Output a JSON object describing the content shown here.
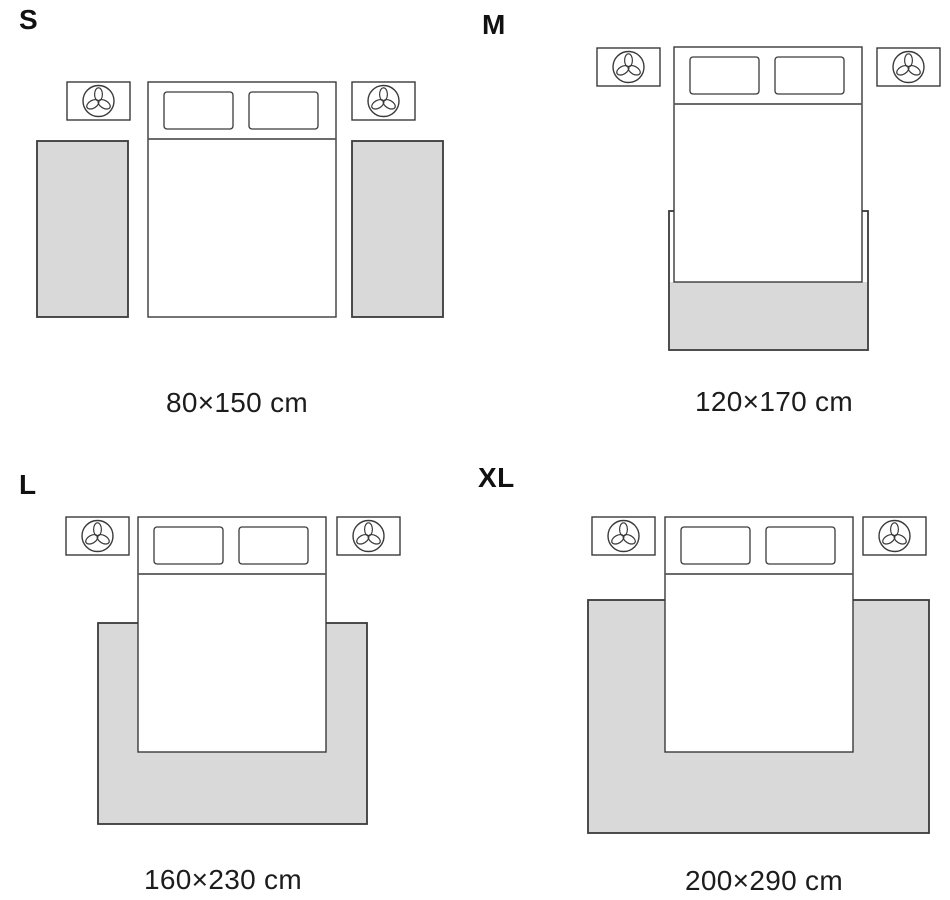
{
  "colors": {
    "background": "#ffffff",
    "rug_fill": "#d9d9d9",
    "outline": "#3a3a3a",
    "label_text": "#111111",
    "caption_text": "#1c1c1c"
  },
  "icons": {
    "nightstand_decoration": "plant-icon"
  },
  "quadrants": [
    {
      "id": "s",
      "label": "S",
      "caption": "80×150 cm",
      "size_cm": {
        "width": 80,
        "length": 150
      },
      "rug_layout": "two side runners beside bed"
    },
    {
      "id": "m",
      "label": "M",
      "caption": "120×170 cm",
      "size_cm": {
        "width": 120,
        "length": 170
      },
      "rug_layout": "rug under lower end of bed"
    },
    {
      "id": "l",
      "label": "L",
      "caption": "160×230 cm",
      "size_cm": {
        "width": 160,
        "length": 230
      },
      "rug_layout": "rug under two-thirds of bed"
    },
    {
      "id": "xl",
      "label": "XL",
      "caption": "200×290 cm",
      "size_cm": {
        "width": 200,
        "length": 290
      },
      "rug_layout": "large rug under bed extending on all sides"
    }
  ]
}
